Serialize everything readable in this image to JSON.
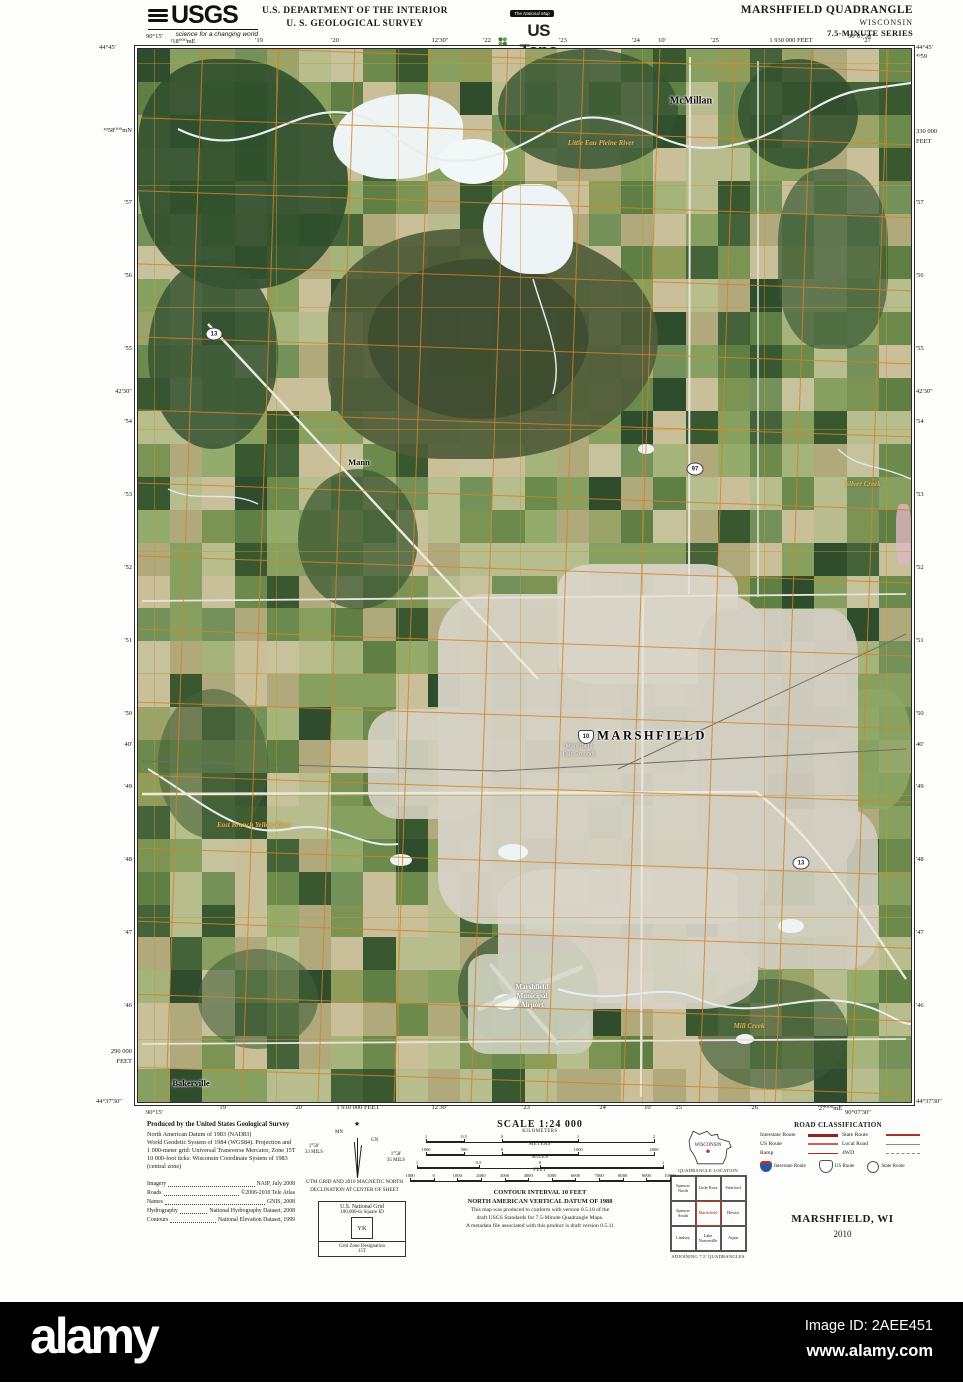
{
  "colors": {
    "accent_red": "#b5342c",
    "grid_orange": "#d28428",
    "interstate_blue": "#2758a8",
    "water_label_orange": "#ecb14a"
  },
  "header": {
    "usgs": "USGS",
    "usgs_tagline": "science for a changing world",
    "dept_line1": "U.S. DEPARTMENT OF THE INTERIOR",
    "dept_line2": "U. S. GEOLOGICAL SURVEY",
    "natmap": "The National Map",
    "ustopo": "US Topo",
    "quad_title": "MARSHFIELD QUADRANGLE",
    "quad_state": "WISCONSIN",
    "quad_series": "7.5-MINUTE SERIES"
  },
  "margins": {
    "corners": {
      "tl_lon": "90°15'",
      "tl_lat": "44°45'",
      "tr_lon": "90°07'30″",
      "tr_lat": "44°45'",
      "bl_lat": "44°37'30″",
      "bl_lon": "90°15'",
      "br_lat": "44°37'30″",
      "br_lon": "90°07'30″"
    },
    "top_ticks": [
      {
        "x": 183,
        "label": "¹18⁰⁰⁰mE"
      },
      {
        "x": 259,
        "label": "'19"
      },
      {
        "x": 335,
        "label": "'20"
      },
      {
        "x": 440,
        "label": "12'30″"
      },
      {
        "x": 487,
        "label": "'22"
      },
      {
        "x": 563,
        "label": "'23"
      },
      {
        "x": 636,
        "label": "'24"
      },
      {
        "x": 662,
        "label": "10'"
      },
      {
        "x": 715,
        "label": "'25"
      },
      {
        "x": 791,
        "label": "1 930 000 FEET"
      },
      {
        "x": 867,
        "label": "'27"
      }
    ],
    "bottom_ticks": [
      {
        "x": 222,
        "label": "'19"
      },
      {
        "x": 298,
        "label": "'20"
      },
      {
        "x": 358,
        "label": "1 910 000 FEET"
      },
      {
        "x": 440,
        "label": "12'30″"
      },
      {
        "x": 526,
        "label": "'23"
      },
      {
        "x": 602,
        "label": "'24"
      },
      {
        "x": 648,
        "label": "10'"
      },
      {
        "x": 678,
        "label": "'25"
      },
      {
        "x": 754,
        "label": "'26"
      },
      {
        "x": 830,
        "label": "'27⁰⁰⁰mE"
      }
    ],
    "left_ticks": [
      {
        "y": 130,
        "label": "⁴⁹58⁰⁰⁰mN"
      },
      {
        "y": 203,
        "label": "'57"
      },
      {
        "y": 276,
        "label": "'56"
      },
      {
        "y": 349,
        "label": "'55"
      },
      {
        "y": 392,
        "label": "42'30″"
      },
      {
        "y": 422,
        "label": "'54"
      },
      {
        "y": 495,
        "label": "'53"
      },
      {
        "y": 568,
        "label": "'52"
      },
      {
        "y": 641,
        "label": "'51"
      },
      {
        "y": 714,
        "label": "'50"
      },
      {
        "y": 745,
        "label": "40'"
      },
      {
        "y": 787,
        "label": "'49"
      },
      {
        "y": 860,
        "label": "'48"
      },
      {
        "y": 933,
        "label": "'47"
      },
      {
        "y": 1006,
        "label": "'46"
      },
      {
        "y": 1052,
        "label": "290 000"
      },
      {
        "y": 1062,
        "label": "FEET"
      }
    ],
    "right_ticks": [
      {
        "y": 57,
        "label": "⁴⁹59"
      },
      {
        "y": 132,
        "label": "330 000"
      },
      {
        "y": 142,
        "label": "FEET"
      },
      {
        "y": 203,
        "label": "'57"
      },
      {
        "y": 276,
        "label": "'56"
      },
      {
        "y": 349,
        "label": "'55"
      },
      {
        "y": 392,
        "label": "42'30″"
      },
      {
        "y": 422,
        "label": "'54"
      },
      {
        "y": 495,
        "label": "'53"
      },
      {
        "y": 568,
        "label": "'52"
      },
      {
        "y": 641,
        "label": "'51"
      },
      {
        "y": 714,
        "label": "'50"
      },
      {
        "y": 745,
        "label": "40'"
      },
      {
        "y": 787,
        "label": "'49"
      },
      {
        "y": 860,
        "label": "'48"
      },
      {
        "y": 933,
        "label": "'47"
      },
      {
        "y": 1006,
        "label": "'46"
      }
    ]
  },
  "map": {
    "labels": [
      {
        "text": "McMillan",
        "x": 690,
        "y": 100,
        "cls": "town"
      },
      {
        "text": "Mann",
        "x": 358,
        "y": 461,
        "cls": "town-sm"
      },
      {
        "text": "MARSHFIELD",
        "x": 651,
        "y": 735,
        "cls": "city"
      },
      {
        "text": "Bakerville",
        "x": 190,
        "y": 1082,
        "cls": "town-sm"
      },
      {
        "text": "Marshfield",
        "x": 531,
        "y": 986,
        "cls": "white"
      },
      {
        "text": "Municipal",
        "x": 531,
        "y": 995,
        "cls": "white"
      },
      {
        "text": "Airport",
        "x": 531,
        "y": 1004,
        "cls": "white"
      },
      {
        "text": "Marshfield",
        "x": 578,
        "y": 745,
        "cls": "white-sm"
      },
      {
        "text": "Fair Grounds",
        "x": 578,
        "y": 753,
        "cls": "white-sm"
      },
      {
        "text": "Little Eau Pleine River",
        "x": 600,
        "y": 142,
        "cls": "water"
      },
      {
        "text": "East Branch Yellow River",
        "x": 253,
        "y": 824,
        "cls": "water"
      },
      {
        "text": "Mill Creek",
        "x": 748,
        "y": 1025,
        "cls": "water"
      },
      {
        "text": "Silver Creek",
        "x": 862,
        "y": 483,
        "cls": "water"
      }
    ],
    "shields": [
      {
        "x": 213,
        "y": 333,
        "label": "13",
        "type": "state"
      },
      {
        "x": 694,
        "y": 468,
        "label": "97",
        "type": "state"
      },
      {
        "x": 585,
        "y": 736,
        "label": "10",
        "type": "us"
      },
      {
        "x": 800,
        "y": 862,
        "label": "13",
        "type": "state"
      }
    ]
  },
  "footer": {
    "produced": {
      "title": "Produced by the United States Geological Survey",
      "lines": [
        "North American Datum of 1983 (NAD83)",
        "World Geodetic System of 1984 (WGS84). Projection and",
        "1 000-meter grid: Universal Transverse Mercator, Zone 15T",
        "10 000-foot ticks: Wisconsin Coordinate System of 1983",
        "(central zone)"
      ],
      "sources": [
        {
          "k": "Imagery",
          "v": "NAIP, July 2008"
        },
        {
          "k": "Roads",
          "v": "©2006-2010 Tele Atlas"
        },
        {
          "k": "Names",
          "v": "GNIS, 2008"
        },
        {
          "k": "Hydrography",
          "v": "National Hydrography Dataset, 2008"
        },
        {
          "k": "Contours",
          "v": "National Elevation Dataset, 1999"
        }
      ]
    },
    "declination": {
      "title1": "UTM GRID AND 2010 MAGNETIC NORTH",
      "title2": "DECLINATION AT CENTER OF SHEET",
      "mn_label": "MN",
      "gn_label": "GN",
      "mn_angle": "1°50'",
      "mn_mils": "33 MILS",
      "gn_angle": "1°58'",
      "gn_mils": "35 MILS"
    },
    "usng": {
      "title": "U.S. National Grid",
      "sub": "100,000-m Square ID",
      "square_id": "YK",
      "gzd_label": "Grid Zone Designation",
      "gzd": "15T"
    },
    "scale": {
      "title": "SCALE 1:24 000",
      "bars": [
        {
          "unit": "KILOMETERS",
          "w": 228,
          "ticks": [
            {
              "f": 0,
              "n": "1"
            },
            {
              "f": 0.167,
              "n": "0.5"
            },
            {
              "f": 0.333,
              "n": "0"
            },
            {
              "f": 0.667,
              "n": "1"
            },
            {
              "f": 1,
              "n": "2"
            }
          ]
        },
        {
          "unit": "METERS",
          "w": 228,
          "ticks": [
            {
              "f": 0,
              "n": "1000"
            },
            {
              "f": 0.167,
              "n": "500"
            },
            {
              "f": 0.333,
              "n": "0"
            },
            {
              "f": 0.667,
              "n": "1000"
            },
            {
              "f": 1,
              "n": "2000"
            }
          ]
        },
        {
          "unit": "MILES",
          "w": 246,
          "ticks": [
            {
              "f": 0,
              "n": "1"
            },
            {
              "f": 0.25,
              "n": "0.5"
            },
            {
              "f": 0.5,
              "n": "0"
            },
            {
              "f": 1,
              "n": "1"
            }
          ]
        },
        {
          "unit": "FEET",
          "w": 260,
          "ticks": [
            {
              "f": 0,
              "n": "1000"
            },
            {
              "f": 0.0909,
              "n": "0"
            },
            {
              "f": 0.1818,
              "n": "1000"
            },
            {
              "f": 0.2727,
              "n": "2000"
            },
            {
              "f": 0.3636,
              "n": "3000"
            },
            {
              "f": 0.4545,
              "n": "4000"
            },
            {
              "f": 0.5455,
              "n": "5000"
            },
            {
              "f": 0.6364,
              "n": "6000"
            },
            {
              "f": 0.7273,
              "n": "7000"
            },
            {
              "f": 0.8182,
              "n": "8000"
            },
            {
              "f": 0.9091,
              "n": "9000"
            },
            {
              "f": 1,
              "n": "10000"
            }
          ]
        }
      ]
    },
    "contour": [
      "CONTOUR INTERVAL 10 FEET",
      "NORTH AMERICAN VERTICAL DATUM OF 1988"
    ],
    "standards": [
      "This map was produced to conform with version 0.5.10 of the",
      "draft USGS Standards for 7.5-Minute Quadrangle Maps.",
      "A metadata file associated with this product is draft version 0.5.11"
    ],
    "location": {
      "state_label": "WISCONSIN",
      "caption_top": "QUADRANGLE LOCATION",
      "caption_bottom": "ADJOINING 7.5' QUADRANGLES",
      "grid": [
        [
          "Spencer North",
          "Little Rose",
          "Stratford"
        ],
        [
          "Spencer South",
          "Marshfield",
          "Hewitt"
        ],
        [
          "Lindsey",
          "Lake Nasonville",
          "Arpin"
        ]
      ],
      "selected": "Marshfield"
    },
    "roadclass": {
      "title": "ROAD CLASSIFICATION",
      "rows": [
        {
          "label": "Interstate Route",
          "style": "interstate"
        },
        {
          "label": "US Route",
          "style": "us"
        },
        {
          "label": "Ramp",
          "style": "ramp"
        },
        {
          "label": "State Route",
          "style": "state"
        },
        {
          "label": "Local Road",
          "style": "local"
        },
        {
          "label": "4WD",
          "style": "fourwd"
        }
      ],
      "shields": [
        {
          "type": "interstate",
          "label": "Interstate Route"
        },
        {
          "type": "us",
          "label": "US Route"
        },
        {
          "type": "state",
          "label": "State Route"
        }
      ]
    },
    "sheet_name": "MARSHFIELD, WI",
    "sheet_year": "2010"
  },
  "watermark": {
    "logo": "alamy",
    "image_id": "Image ID: 2AEE451",
    "url": "www.alamy.com"
  }
}
